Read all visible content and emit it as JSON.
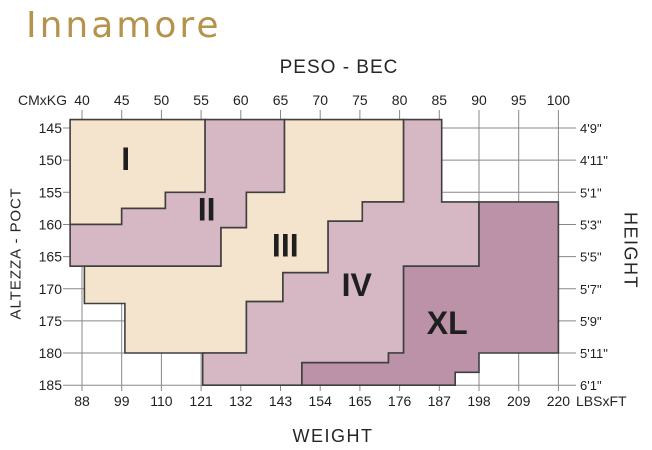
{
  "logo": {
    "text": "Innamore",
    "color": "#b6934d"
  },
  "chart_data": {
    "type": "area",
    "title_top": "PESO - ВЕС",
    "title_bottom": "WEIGHT",
    "title_left": "ALTEZZA - РОСТ",
    "title_right": "HEIGHT",
    "top_axis": {
      "unit_label": "CMxKG",
      "unit": "kg",
      "ticks": [
        40,
        45,
        50,
        55,
        60,
        65,
        70,
        75,
        80,
        85,
        90,
        95,
        100
      ]
    },
    "bottom_axis": {
      "unit_label": "LBSxFT",
      "unit": "lbs",
      "ticks": [
        88,
        99,
        110,
        121,
        132,
        143,
        154,
        165,
        176,
        187,
        198,
        209,
        220
      ]
    },
    "left_axis": {
      "unit": "cm",
      "ticks": [
        145,
        150,
        155,
        160,
        165,
        170,
        175,
        180,
        185
      ]
    },
    "right_axis": {
      "unit": "ft-in",
      "ticks": [
        "4'9\"",
        "4'11\"",
        "5'1\"",
        "5'3\"",
        "5'5\"",
        "5'7\"",
        "5'9\"",
        "5'11\"",
        "6'1\""
      ]
    },
    "x_range_kg": [
      40,
      100
    ],
    "y_range_cm": [
      145,
      185
    ],
    "grid": true,
    "colors": {
      "grid": "#888888",
      "outline": "#3f3f3f",
      "text": "#1f1f1f",
      "cream": "#f4e3cd",
      "mauve": "#d5b8c3",
      "dark_mauve": "#bc92a8"
    },
    "regions": [
      {
        "label": "I",
        "fill": "#f4e3cd",
        "label_at": [
          45.5,
          149.8
        ],
        "points_kg_cm": [
          [
            38.5,
            143.7
          ],
          [
            55.5,
            143.7
          ],
          [
            55.5,
            155
          ],
          [
            50.5,
            155
          ],
          [
            50.5,
            157.5
          ],
          [
            45,
            157.5
          ],
          [
            45,
            160
          ],
          [
            38.5,
            160
          ]
        ]
      },
      {
        "label": "II",
        "fill": "#d5b8c3",
        "label_at": [
          55.7,
          157.7
        ],
        "points_kg_cm": [
          [
            55.5,
            143.7
          ],
          [
            65.5,
            143.7
          ],
          [
            65.5,
            155
          ],
          [
            60.7,
            155
          ],
          [
            60.7,
            160.5
          ],
          [
            57.5,
            160.5
          ],
          [
            57.5,
            166.5
          ],
          [
            38.5,
            166.5
          ],
          [
            38.5,
            160
          ],
          [
            45,
            160
          ],
          [
            45,
            157.5
          ],
          [
            50.5,
            157.5
          ],
          [
            50.5,
            155
          ],
          [
            55.5,
            155
          ]
        ]
      },
      {
        "label": "III",
        "fill": "#f4e3cd",
        "label_at": [
          65.6,
          163.3
        ],
        "points_kg_cm": [
          [
            65.5,
            143.7
          ],
          [
            80.5,
            143.7
          ],
          [
            80.5,
            156.5
          ],
          [
            75.3,
            156.5
          ],
          [
            75.3,
            159.5
          ],
          [
            71,
            159.5
          ],
          [
            71,
            167.5
          ],
          [
            65.3,
            167.5
          ],
          [
            65.3,
            172
          ],
          [
            60.7,
            172
          ],
          [
            60.7,
            180
          ],
          [
            45.4,
            180
          ],
          [
            45.4,
            172.3
          ],
          [
            40.3,
            172.3
          ],
          [
            40.3,
            166.5
          ],
          [
            57.5,
            166.5
          ],
          [
            57.5,
            160.5
          ],
          [
            60.7,
            160.5
          ],
          [
            60.7,
            155
          ],
          [
            65.5,
            155
          ]
        ]
      },
      {
        "label": "IV",
        "fill": "#d5b8c3",
        "label_at": [
          74.6,
          169.4
        ],
        "points_kg_cm": [
          [
            80.5,
            143.7
          ],
          [
            85.3,
            143.7
          ],
          [
            85.3,
            156.5
          ],
          [
            90,
            156.5
          ],
          [
            90,
            166.5
          ],
          [
            80.5,
            166.5
          ],
          [
            80.5,
            180
          ],
          [
            78.6,
            180
          ],
          [
            78.6,
            181.5
          ],
          [
            67.7,
            181.5
          ],
          [
            67.7,
            185
          ],
          [
            55.2,
            185
          ],
          [
            55.2,
            180
          ],
          [
            60.7,
            180
          ],
          [
            60.7,
            172
          ],
          [
            65.3,
            172
          ],
          [
            65.3,
            167.5
          ],
          [
            71,
            167.5
          ],
          [
            71,
            159.5
          ],
          [
            75.3,
            159.5
          ],
          [
            75.3,
            156.5
          ],
          [
            80.5,
            156.5
          ]
        ]
      },
      {
        "label": "XL",
        "fill": "#bc92a8",
        "label_at": [
          86,
          175.3
        ],
        "points_kg_cm": [
          [
            90,
            156.5
          ],
          [
            100,
            156.5
          ],
          [
            100,
            180
          ],
          [
            90,
            180
          ],
          [
            90,
            183
          ],
          [
            87,
            183
          ],
          [
            87,
            185
          ],
          [
            67.7,
            185
          ],
          [
            67.7,
            181.5
          ],
          [
            78.6,
            181.5
          ],
          [
            78.6,
            180
          ],
          [
            80.5,
            180
          ],
          [
            80.5,
            166.5
          ],
          [
            90,
            166.5
          ]
        ]
      }
    ]
  }
}
